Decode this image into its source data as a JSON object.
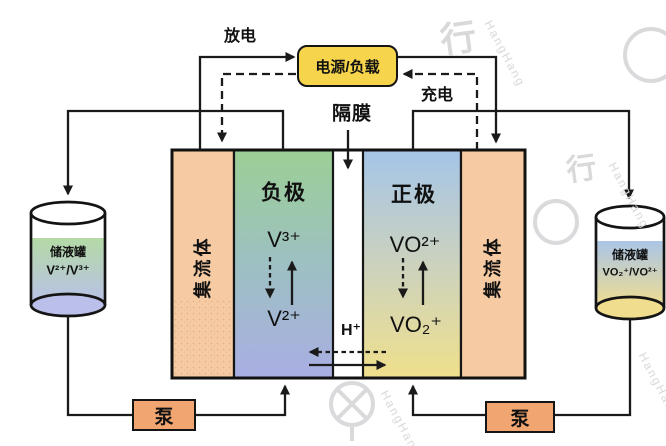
{
  "labels": {
    "discharge": "放电",
    "charge": "充电",
    "power_load": "电源/负载",
    "membrane": "隔膜"
  },
  "cell": {
    "left_collector_label": "集流体",
    "right_collector_label": "集流体",
    "negative": {
      "label": "负极",
      "oxidized": "V³⁺",
      "reduced": "V²⁺"
    },
    "positive": {
      "label": "正极",
      "oxidized": "VO²⁺",
      "reduced": "VO₂⁺"
    },
    "proton_label": "H⁺"
  },
  "tanks": {
    "left": {
      "label": "储液罐",
      "species": "V²⁺/V³⁺"
    },
    "right": {
      "label": "储液罐",
      "species": "VO₂⁺/VO²⁺"
    }
  },
  "pumps": {
    "left_label": "泵",
    "right_label": "泵"
  },
  "watermark": {
    "glyph": "行",
    "latin": "HangHang"
  },
  "colors": {
    "wire": "#1a1a1a",
    "collector_fill": "#f6cba4",
    "neg_top": "#9ccf95",
    "neg_bottom": "#a9aee3",
    "pos_top": "#a5c5e8",
    "pos_bottom": "#f0e08c",
    "power_box_fill": "#f6d44c",
    "pump_fill": "#f1a671",
    "tank_left_top": "#b4daa5",
    "tank_left_bottom": "#bac0ea",
    "tank_right_top": "#aac5e7",
    "tank_right_bottom": "#f1dd8e"
  }
}
